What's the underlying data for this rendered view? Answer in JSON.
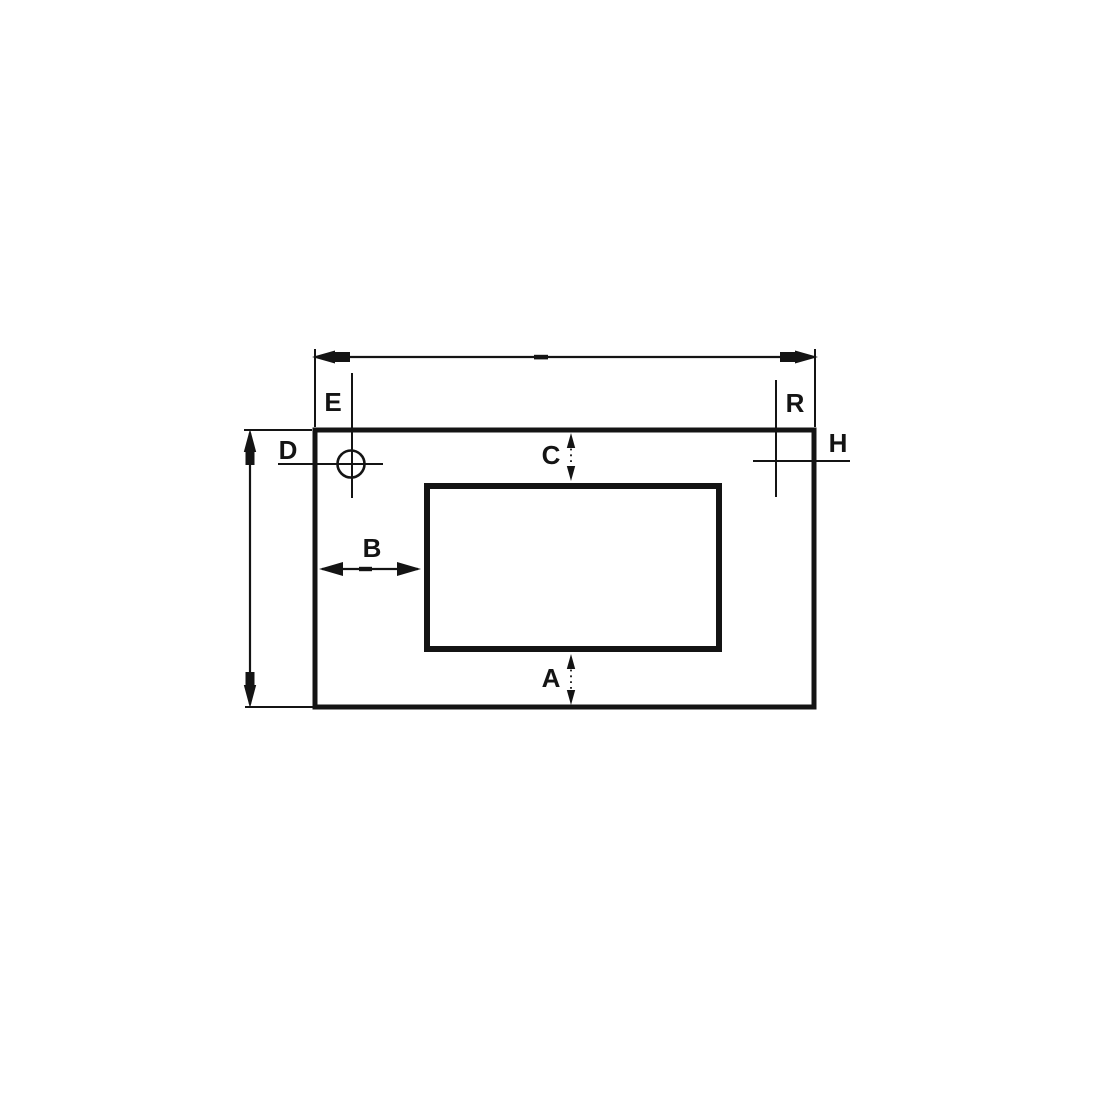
{
  "diagram": {
    "type": "technical-dimension-drawing",
    "description": "Rectangular panel with inner rectangular cutout, two corner hole/center marks and lettered dimension callouts",
    "colors": {
      "line": "#141414",
      "background": "#ffffff"
    },
    "labels": {
      "A": "A",
      "B": "B",
      "C": "C",
      "D": "D",
      "E": "E",
      "H": "H",
      "R": "R"
    },
    "dimensions": [
      {
        "label": "E",
        "refers_to": "top-left hole center mark (circle with crosshair)"
      },
      {
        "label": "R",
        "refers_to": "top-right center mark (crosshair)"
      },
      {
        "label": "D",
        "refers_to": "overall panel height (left vertical dimension)"
      },
      {
        "label": "H",
        "refers_to": "right-side crosshair mark"
      },
      {
        "label": "C",
        "refers_to": "gap between panel top edge and cutout top edge"
      },
      {
        "label": "B",
        "refers_to": "gap between panel left edge and cutout left edge"
      },
      {
        "label": "A",
        "refers_to": "gap between cutout bottom edge and panel bottom edge"
      },
      {
        "label": "",
        "refers_to": "overall panel width (top horizontal dimension, unlabeled)"
      }
    ]
  }
}
